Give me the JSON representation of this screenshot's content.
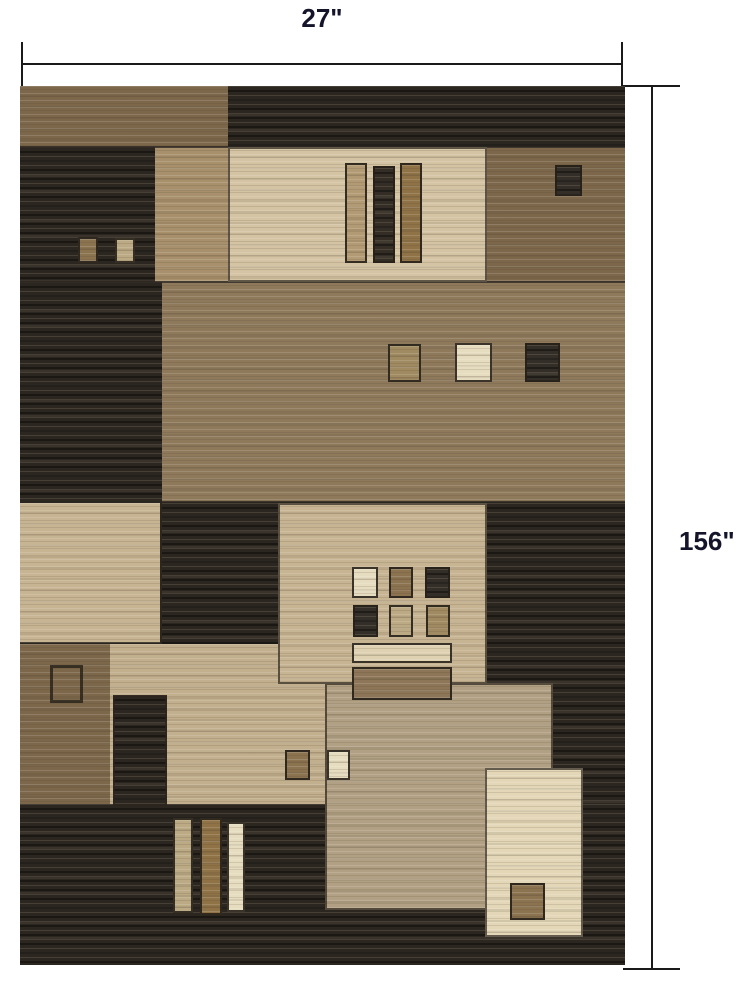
{
  "annotations": {
    "width_label": "27\"",
    "height_label": "156\""
  },
  "palette": {
    "line": "#1a1a1a",
    "label": "#14142a",
    "seam": "#2c2620",
    "dark": "#2b2620",
    "brown": "#7c674a",
    "brown_mid": "#8e795b",
    "tan": "#a7906b",
    "beige_top": "#d4c4a3",
    "beige": "#c7b493",
    "beige_low": "#c2af8d",
    "taupe": "#b1a083",
    "cream": "#e3d7b8",
    "bar_tan": "#b29b74",
    "bar_dark": "#332d26",
    "bar_brown": "#8f7347",
    "hbar_cream": "#ded2b2",
    "hbar_brown": "#8c7657",
    "sq_brown": "#8b7350",
    "sq_beige": "#bcaa85",
    "sq_cream": "#e6dcc0",
    "sq_dark": "#332e28",
    "sq_tan": "#a08a62"
  }
}
